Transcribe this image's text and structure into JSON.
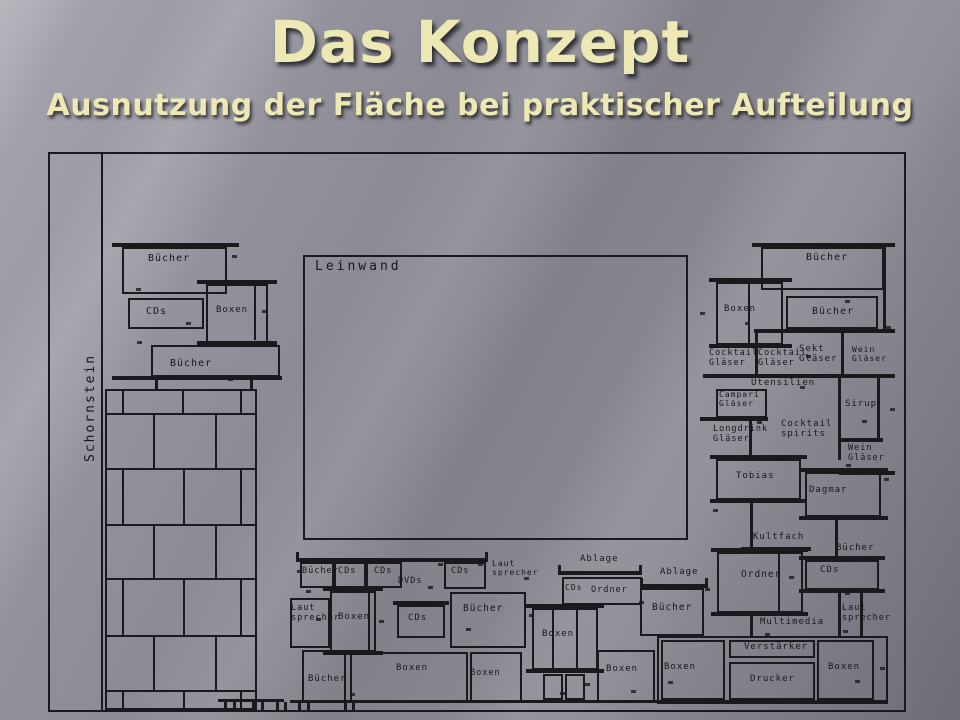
{
  "slide": {
    "title": "Das Konzept",
    "subtitle": "Ausnutzung der Fläche bei praktischer Aufteilung"
  },
  "drawing": {
    "line_color": "#1a1a1e",
    "frame": {
      "x": 48,
      "y": 152,
      "w": 858,
      "h": 560
    },
    "chimney": {
      "label_region": "left-wall",
      "x": 105,
      "y": 389,
      "w": 152,
      "h": 321,
      "row_lines": [
        413,
        468,
        524,
        578,
        635,
        690
      ],
      "row_bounds": [
        389,
        413,
        468,
        524,
        578,
        635,
        690,
        710
      ],
      "joints": [
        [
          122,
          182,
          240
        ],
        [
          153,
          215
        ],
        [
          122,
          183,
          240
        ],
        [
          153,
          215
        ],
        [
          122,
          183,
          240
        ],
        [
          153,
          215
        ],
        [
          122,
          183,
          240
        ]
      ]
    },
    "rects": [
      {
        "n": "leinwand-box",
        "x": 303,
        "y": 255,
        "w": 385,
        "h": 285
      },
      {
        "n": "box-buecher-ul-1",
        "x": 122,
        "y": 247,
        "w": 105,
        "h": 47
      },
      {
        "n": "box-cds-ul",
        "x": 128,
        "y": 298,
        "w": 76,
        "h": 31
      },
      {
        "n": "box-boxen-ul",
        "x": 206,
        "y": 284,
        "w": 62,
        "h": 59
      },
      {
        "n": "box-buecher-ul-2",
        "x": 151,
        "y": 345,
        "w": 129,
        "h": 32
      },
      {
        "n": "box-buecher-rt-1",
        "x": 761,
        "y": 247,
        "w": 123,
        "h": 43
      },
      {
        "n": "box-boxen-rt",
        "x": 716,
        "y": 282,
        "w": 67,
        "h": 63
      },
      {
        "n": "box-buecher-rt-2",
        "x": 786,
        "y": 296,
        "w": 92,
        "h": 33
      },
      {
        "n": "box-campari",
        "x": 716,
        "y": 389,
        "w": 51,
        "h": 29
      },
      {
        "n": "box-tobias",
        "x": 716,
        "y": 459,
        "w": 85,
        "h": 41
      },
      {
        "n": "box-dagmar",
        "x": 805,
        "y": 472,
        "w": 76,
        "h": 45
      },
      {
        "n": "box-ordner-r",
        "x": 717,
        "y": 552,
        "w": 86,
        "h": 61
      },
      {
        "n": "box-cds-r",
        "x": 805,
        "y": 560,
        "w": 74,
        "h": 30
      },
      {
        "n": "cabinet-bottom-right",
        "x": 657,
        "y": 636,
        "w": 231,
        "h": 68
      },
      {
        "n": "box-boxen-cab-left",
        "x": 661,
        "y": 640,
        "w": 64,
        "h": 60
      },
      {
        "n": "box-verstaerker",
        "x": 729,
        "y": 640,
        "w": 86,
        "h": 18
      },
      {
        "n": "box-drucker",
        "x": 729,
        "y": 662,
        "w": 86,
        "h": 38
      },
      {
        "n": "box-boxen-cab-right",
        "x": 817,
        "y": 640,
        "w": 57,
        "h": 60
      },
      {
        "n": "box-buecher-bc",
        "x": 300,
        "y": 562,
        "w": 34,
        "h": 26
      },
      {
        "n": "box-cds-bc-a",
        "x": 334,
        "y": 562,
        "w": 32,
        "h": 26
      },
      {
        "n": "box-cds-bc-b",
        "x": 366,
        "y": 562,
        "w": 36,
        "h": 26
      },
      {
        "n": "box-cds-bc-c",
        "x": 444,
        "y": 562,
        "w": 42,
        "h": 27
      },
      {
        "n": "box-lautsprecher-left",
        "x": 290,
        "y": 598,
        "w": 40,
        "h": 50
      },
      {
        "n": "box-boxen-spk-left",
        "x": 330,
        "y": 591,
        "w": 46,
        "h": 61
      },
      {
        "n": "box-cds-tower",
        "x": 397,
        "y": 605,
        "w": 48,
        "h": 33
      },
      {
        "n": "box-buecher-mid-left",
        "x": 450,
        "y": 592,
        "w": 76,
        "h": 56
      },
      {
        "n": "box-cds-ordner",
        "x": 562,
        "y": 577,
        "w": 80,
        "h": 28
      },
      {
        "n": "box-buecher-mid-right",
        "x": 640,
        "y": 588,
        "w": 64,
        "h": 48
      },
      {
        "n": "box-boxen-center-tower",
        "x": 532,
        "y": 608,
        "w": 66,
        "h": 62
      },
      {
        "n": "tower-leg-1",
        "x": 543,
        "y": 674,
        "w": 20,
        "h": 26
      },
      {
        "n": "tower-leg-2",
        "x": 565,
        "y": 674,
        "w": 20,
        "h": 26
      },
      {
        "n": "box-buecher-bottom",
        "x": 302,
        "y": 650,
        "w": 44,
        "h": 52
      },
      {
        "n": "box-boxen-bottom-1",
        "x": 350,
        "y": 652,
        "w": 118,
        "h": 50
      },
      {
        "n": "box-boxen-bottom-2",
        "x": 470,
        "y": 652,
        "w": 52,
        "h": 50
      },
      {
        "n": "box-boxen-bottom-3",
        "x": 597,
        "y": 650,
        "w": 58,
        "h": 52
      }
    ],
    "bars": [
      {
        "n": "wall-left-line",
        "x": 101,
        "y": 152,
        "w": 2,
        "h": 560
      },
      {
        "n": "shelf-bar",
        "x": 112,
        "y": 243,
        "w": 127,
        "h": 4
      },
      {
        "n": "flange",
        "x": 197,
        "y": 280,
        "w": 80,
        "h": 4
      },
      {
        "n": "flange",
        "x": 197,
        "y": 341,
        "w": 80,
        "h": 4
      },
      {
        "n": "speaker-divider",
        "x": 254,
        "y": 286,
        "w": 2,
        "h": 54
      },
      {
        "n": "shelf-bar",
        "x": 112,
        "y": 376,
        "w": 170,
        "h": 4
      },
      {
        "n": "post",
        "x": 155,
        "y": 377,
        "w": 3,
        "h": 12
      },
      {
        "n": "post",
        "x": 250,
        "y": 377,
        "w": 3,
        "h": 12
      },
      {
        "n": "shelf-bar",
        "x": 752,
        "y": 243,
        "w": 143,
        "h": 4
      },
      {
        "n": "flange",
        "x": 709,
        "y": 278,
        "w": 83,
        "h": 4
      },
      {
        "n": "flange",
        "x": 709,
        "y": 344,
        "w": 83,
        "h": 4
      },
      {
        "n": "speaker-divider",
        "x": 748,
        "y": 284,
        "w": 2,
        "h": 59
      },
      {
        "n": "shelf-bar",
        "x": 754,
        "y": 329,
        "w": 141,
        "h": 4
      },
      {
        "n": "post",
        "x": 883,
        "y": 247,
        "w": 3,
        "h": 84
      },
      {
        "n": "post",
        "x": 755,
        "y": 333,
        "w": 3,
        "h": 43
      },
      {
        "n": "post",
        "x": 841,
        "y": 329,
        "w": 3,
        "h": 47
      },
      {
        "n": "shelf-bar",
        "x": 703,
        "y": 374,
        "w": 192,
        "h": 4
      },
      {
        "n": "shelf-bar",
        "x": 700,
        "y": 417,
        "w": 68,
        "h": 4
      },
      {
        "n": "post",
        "x": 749,
        "y": 420,
        "w": 3,
        "h": 37
      },
      {
        "n": "post",
        "x": 838,
        "y": 378,
        "w": 3,
        "h": 82
      },
      {
        "n": "post",
        "x": 877,
        "y": 378,
        "w": 3,
        "h": 62
      },
      {
        "n": "shelf-bar",
        "x": 839,
        "y": 438,
        "w": 44,
        "h": 4
      },
      {
        "n": "shelf-bar",
        "x": 839,
        "y": 471,
        "w": 56,
        "h": 4
      },
      {
        "n": "flange",
        "x": 710,
        "y": 455,
        "w": 97,
        "h": 4
      },
      {
        "n": "flange",
        "x": 710,
        "y": 499,
        "w": 97,
        "h": 4
      },
      {
        "n": "flange",
        "x": 799,
        "y": 468,
        "w": 89,
        "h": 4
      },
      {
        "n": "flange",
        "x": 799,
        "y": 516,
        "w": 89,
        "h": 4
      },
      {
        "n": "post",
        "x": 750,
        "y": 503,
        "w": 3,
        "h": 45
      },
      {
        "n": "shelf-bar",
        "x": 741,
        "y": 547,
        "w": 70,
        "h": 4
      },
      {
        "n": "post",
        "x": 835,
        "y": 517,
        "w": 3,
        "h": 41
      },
      {
        "n": "flange",
        "x": 711,
        "y": 548,
        "w": 97,
        "h": 4
      },
      {
        "n": "flange",
        "x": 711,
        "y": 612,
        "w": 97,
        "h": 4
      },
      {
        "n": "speaker-divider",
        "x": 778,
        "y": 554,
        "w": 2,
        "h": 57
      },
      {
        "n": "shelf-bar",
        "x": 799,
        "y": 556,
        "w": 86,
        "h": 4
      },
      {
        "n": "shelf-bar",
        "x": 799,
        "y": 589,
        "w": 86,
        "h": 4
      },
      {
        "n": "post",
        "x": 838,
        "y": 593,
        "w": 3,
        "h": 43
      },
      {
        "n": "post",
        "x": 860,
        "y": 593,
        "w": 3,
        "h": 43
      },
      {
        "n": "post",
        "x": 750,
        "y": 616,
        "w": 3,
        "h": 22
      },
      {
        "n": "shelf-bar",
        "x": 296,
        "y": 558,
        "w": 192,
        "h": 4
      },
      {
        "n": "cap",
        "x": 296,
        "y": 552,
        "w": 3,
        "h": 10
      },
      {
        "n": "cap",
        "x": 485,
        "y": 552,
        "w": 3,
        "h": 10
      },
      {
        "n": "flange",
        "x": 323,
        "y": 587,
        "w": 60,
        "h": 4
      },
      {
        "n": "flange",
        "x": 323,
        "y": 651,
        "w": 60,
        "h": 4
      },
      {
        "n": "speaker-divider",
        "x": 368,
        "y": 593,
        "w": 2,
        "h": 58
      },
      {
        "n": "shelf-bar",
        "x": 393,
        "y": 601,
        "w": 56,
        "h": 4
      },
      {
        "n": "shelf-bar",
        "x": 558,
        "y": 571,
        "w": 84,
        "h": 4
      },
      {
        "n": "cap",
        "x": 558,
        "y": 565,
        "w": 3,
        "h": 10
      },
      {
        "n": "cap",
        "x": 639,
        "y": 565,
        "w": 3,
        "h": 10
      },
      {
        "n": "shelf-bar",
        "x": 640,
        "y": 584,
        "w": 68,
        "h": 4
      },
      {
        "n": "cap",
        "x": 640,
        "y": 578,
        "w": 3,
        "h": 10
      },
      {
        "n": "cap",
        "x": 705,
        "y": 578,
        "w": 3,
        "h": 10
      },
      {
        "n": "flange",
        "x": 526,
        "y": 604,
        "w": 78,
        "h": 4
      },
      {
        "n": "flange",
        "x": 526,
        "y": 669,
        "w": 78,
        "h": 4
      },
      {
        "n": "speaker-divider",
        "x": 552,
        "y": 610,
        "w": 2,
        "h": 58
      },
      {
        "n": "speaker-divider",
        "x": 576,
        "y": 610,
        "w": 2,
        "h": 58
      },
      {
        "n": "feet-bar",
        "x": 218,
        "y": 699,
        "w": 66,
        "h": 3
      },
      {
        "n": "feet-bar",
        "x": 290,
        "y": 700,
        "w": 598,
        "h": 3
      },
      {
        "n": "foot",
        "x": 224,
        "y": 702,
        "w": 3,
        "h": 9
      },
      {
        "n": "foot",
        "x": 233,
        "y": 702,
        "w": 3,
        "h": 9
      },
      {
        "n": "foot",
        "x": 252,
        "y": 702,
        "w": 3,
        "h": 9
      },
      {
        "n": "foot",
        "x": 261,
        "y": 702,
        "w": 3,
        "h": 9
      },
      {
        "n": "foot",
        "x": 276,
        "y": 702,
        "w": 3,
        "h": 9
      },
      {
        "n": "foot",
        "x": 284,
        "y": 702,
        "w": 3,
        "h": 9
      },
      {
        "n": "foot",
        "x": 298,
        "y": 703,
        "w": 3,
        "h": 8
      },
      {
        "n": "foot",
        "x": 307,
        "y": 703,
        "w": 3,
        "h": 8
      },
      {
        "n": "foot",
        "x": 344,
        "y": 703,
        "w": 3,
        "h": 8
      },
      {
        "n": "foot",
        "x": 352,
        "y": 703,
        "w": 3,
        "h": 8
      }
    ],
    "labels": [
      {
        "t": "Schornstein",
        "x": 84,
        "y": 462,
        "s": 13,
        "ls": 2,
        "r": -90
      },
      {
        "t": "Leinwand",
        "x": 315,
        "y": 260,
        "s": 13,
        "ls": 3
      },
      {
        "t": "Bücher",
        "x": 148,
        "y": 253,
        "s": 10
      },
      {
        "t": "CDs",
        "x": 146,
        "y": 306,
        "s": 10
      },
      {
        "t": "Boxen",
        "x": 216,
        "y": 305,
        "s": 9
      },
      {
        "t": "Bücher",
        "x": 170,
        "y": 358,
        "s": 10
      },
      {
        "t": "Bücher",
        "x": 806,
        "y": 252,
        "s": 10
      },
      {
        "t": "Boxen",
        "x": 724,
        "y": 304,
        "s": 9
      },
      {
        "t": "Bücher",
        "x": 812,
        "y": 306,
        "s": 10
      },
      {
        "t": "Cocktail\nGläser",
        "x": 709,
        "y": 349,
        "s": 8.5
      },
      {
        "t": "Cocktail\nGläser",
        "x": 758,
        "y": 349,
        "s": 8.5
      },
      {
        "t": "Sekt\nGläser",
        "x": 799,
        "y": 344,
        "s": 9
      },
      {
        "t": "Wein\nGläser",
        "x": 852,
        "y": 346,
        "s": 8
      },
      {
        "t": "Utensilien",
        "x": 751,
        "y": 378,
        "s": 9
      },
      {
        "t": "Campari\nGläser",
        "x": 719,
        "y": 391,
        "s": 8
      },
      {
        "t": "Sirup",
        "x": 845,
        "y": 399,
        "s": 9
      },
      {
        "t": "Longdrink\nGläser",
        "x": 713,
        "y": 425,
        "s": 8.5
      },
      {
        "t": "Cocktail\nspirits",
        "x": 781,
        "y": 419,
        "s": 9
      },
      {
        "t": "Wein\nGläser",
        "x": 848,
        "y": 444,
        "s": 8.5
      },
      {
        "t": "Tobias",
        "x": 736,
        "y": 471,
        "s": 9
      },
      {
        "t": "Dagmar",
        "x": 809,
        "y": 485,
        "s": 9
      },
      {
        "t": "Kultfach",
        "x": 753,
        "y": 532,
        "s": 9
      },
      {
        "t": "Bücher",
        "x": 836,
        "y": 543,
        "s": 9
      },
      {
        "t": "Ordner",
        "x": 741,
        "y": 570,
        "s": 9.5
      },
      {
        "t": "CDs",
        "x": 820,
        "y": 565,
        "s": 9
      },
      {
        "t": "Laut\nsprecher",
        "x": 842,
        "y": 604,
        "s": 8.5
      },
      {
        "t": "Multimedia",
        "x": 760,
        "y": 617,
        "s": 9
      },
      {
        "t": "Verstärker",
        "x": 744,
        "y": 642,
        "s": 9
      },
      {
        "t": "Drucker",
        "x": 750,
        "y": 674,
        "s": 9
      },
      {
        "t": "Boxen",
        "x": 828,
        "y": 662,
        "s": 9
      },
      {
        "t": "Boxen",
        "x": 664,
        "y": 662,
        "s": 9
      },
      {
        "t": "Bücher",
        "x": 302,
        "y": 567,
        "s": 8.5
      },
      {
        "t": "CDs",
        "x": 338,
        "y": 567,
        "s": 8.5
      },
      {
        "t": "CDs",
        "x": 374,
        "y": 567,
        "s": 8.5
      },
      {
        "t": "DVDs",
        "x": 398,
        "y": 577,
        "s": 8.5
      },
      {
        "t": "CDs",
        "x": 451,
        "y": 567,
        "s": 8.5
      },
      {
        "t": "Laut\nsprecher",
        "x": 492,
        "y": 560,
        "s": 8
      },
      {
        "t": "Ablage",
        "x": 580,
        "y": 554,
        "s": 9
      },
      {
        "t": "CDs",
        "x": 565,
        "y": 584,
        "s": 8
      },
      {
        "t": "Ordner",
        "x": 591,
        "y": 586,
        "s": 8.5
      },
      {
        "t": "Ablage",
        "x": 660,
        "y": 567,
        "s": 9
      },
      {
        "t": "Bücher",
        "x": 463,
        "y": 604,
        "s": 9.5
      },
      {
        "t": "Bücher",
        "x": 652,
        "y": 603,
        "s": 9.5
      },
      {
        "t": "Laut\nsprecher",
        "x": 291,
        "y": 604,
        "s": 8.5
      },
      {
        "t": "Boxen",
        "x": 338,
        "y": 612,
        "s": 9
      },
      {
        "t": "CDs",
        "x": 408,
        "y": 613,
        "s": 9
      },
      {
        "t": "Boxen",
        "x": 542,
        "y": 629,
        "s": 9
      },
      {
        "t": "Bücher",
        "x": 308,
        "y": 674,
        "s": 9
      },
      {
        "t": "Boxen",
        "x": 396,
        "y": 663,
        "s": 9
      },
      {
        "t": "Boxen",
        "x": 470,
        "y": 669,
        "s": 8.5
      },
      {
        "t": "Boxen",
        "x": 606,
        "y": 664,
        "s": 9
      }
    ],
    "ticks": [
      [
        232,
        255
      ],
      [
        136,
        288
      ],
      [
        262,
        310
      ],
      [
        186,
        322
      ],
      [
        137,
        341
      ],
      [
        228,
        378
      ],
      [
        845,
        300
      ],
      [
        700,
        312
      ],
      [
        745,
        322
      ],
      [
        886,
        326
      ],
      [
        806,
        355
      ],
      [
        800,
        386
      ],
      [
        890,
        408
      ],
      [
        757,
        421
      ],
      [
        862,
        420
      ],
      [
        846,
        464
      ],
      [
        884,
        478
      ],
      [
        713,
        509
      ],
      [
        789,
        576
      ],
      [
        845,
        592
      ],
      [
        765,
        633
      ],
      [
        880,
        667
      ],
      [
        855,
        680
      ],
      [
        843,
        630
      ],
      [
        306,
        590
      ],
      [
        316,
        618
      ],
      [
        379,
        620
      ],
      [
        428,
        586
      ],
      [
        466,
        628
      ],
      [
        529,
        614
      ],
      [
        438,
        563
      ],
      [
        478,
        563
      ],
      [
        524,
        577
      ],
      [
        639,
        601
      ],
      [
        705,
        588
      ],
      [
        297,
        570
      ],
      [
        585,
        683
      ],
      [
        560,
        692
      ],
      [
        350,
        693
      ],
      [
        631,
        690
      ],
      [
        668,
        681
      ]
    ]
  }
}
